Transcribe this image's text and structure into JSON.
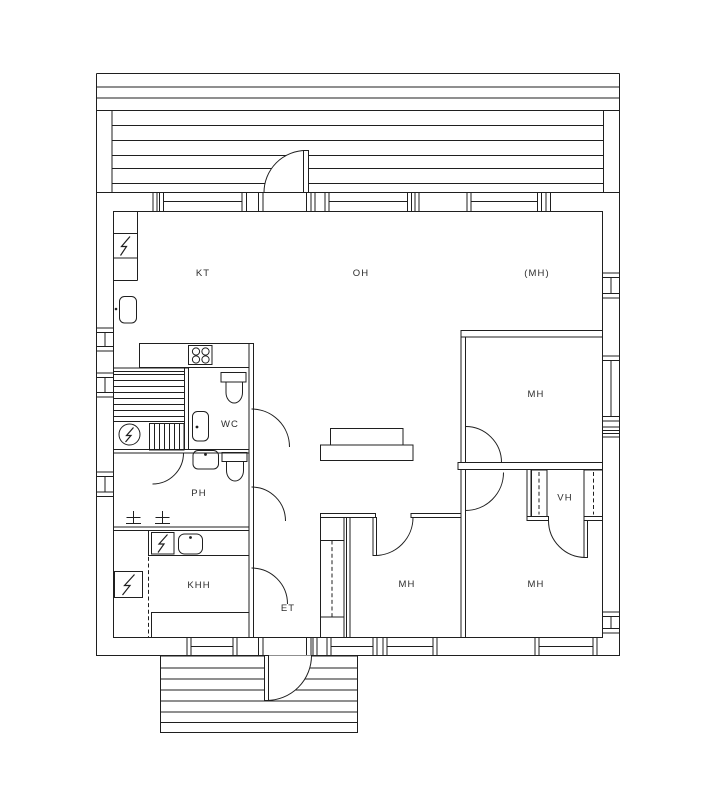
{
  "plan": {
    "rooms": {
      "kt": {
        "label": "KT"
      },
      "oh": {
        "label": "OH"
      },
      "mh_reserve": {
        "label": "(MH)"
      },
      "mh_top_right": {
        "label": "MH"
      },
      "vh": {
        "label": "VH"
      },
      "mh_bottom_right": {
        "label": "MH"
      },
      "mh_bottom_middle": {
        "label": "MH"
      },
      "wc": {
        "label": "WC"
      },
      "ph": {
        "label": "PH"
      },
      "khh": {
        "label": "KHH"
      },
      "et": {
        "label": "ET"
      }
    },
    "symbols": {
      "electric_panel": "lightning-bolt-in-box",
      "sauna_heater": "lightning-bolt-in-circle",
      "washing_machine": "lightning-bolt-in-box",
      "water_heater": "lightning-bolt-in-box",
      "stove": "four-burner-cooktop",
      "toilet": "toilet-plan-symbol",
      "sink": "washbasin-rounded-square-with-dot",
      "bathtub": "rounded-rect-with-dot",
      "floor_drain": "cross-with-base",
      "wardrobe_rail": "dashed-line",
      "door": "quarter-circle-swing-arc",
      "window": "double-line-with-end-caps"
    },
    "colors": {
      "line": "#1f1f1f",
      "background": "#ffffff",
      "label": "#2d2d2d"
    }
  }
}
